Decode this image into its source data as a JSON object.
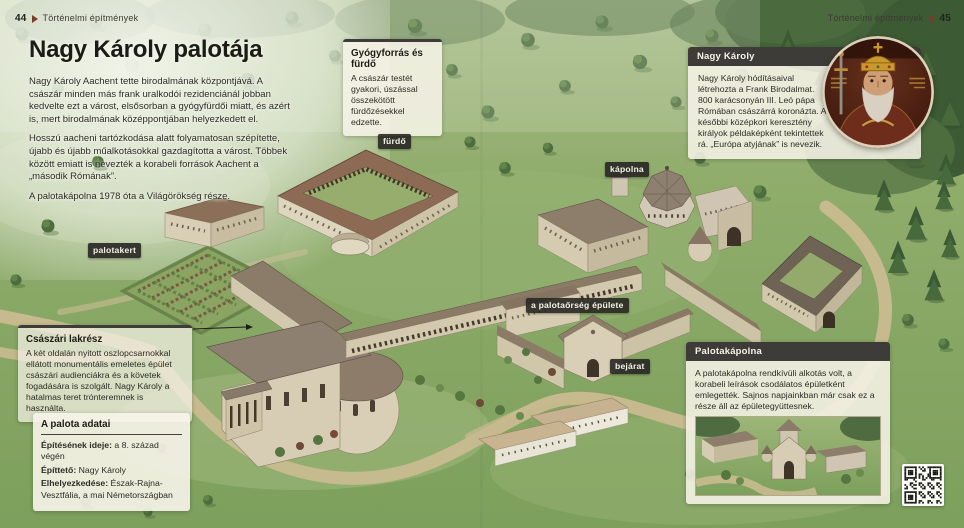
{
  "header": {
    "left": {
      "page_number": "44",
      "section": "Történelmi építmények"
    },
    "right": {
      "page_number": "45",
      "section": "Történelmi építmények"
    }
  },
  "article": {
    "title": "Nagy Károly palotája",
    "paragraphs": [
      "Nagy Károly Aachent tette birodalmának központjává. A császár minden más frank uralkodói rezidenciánál jobban kedvelte ezt a várost, elsősorban a gyógyfürdői miatt, és azért is, mert birodalmának középpontjában helyezkedett el.",
      "Hosszú aacheni tartózkodása alatt folyamatosan szépítette, újabb és újabb műalkotásokkal gazdagította a várost. Többek között emiatt is nevezték a korabeli források Aachent a „második Rómának”.",
      "A palotakápolna 1978 óta a Világörökség része."
    ]
  },
  "callouts": {
    "bath": {
      "title": "Gyógyforrás és fürdő",
      "body": "A császár testét gyakori, úszással összekötött fürdőzésekkel edzette."
    },
    "charlemagne": {
      "title": "Nagy Károly",
      "body": "Nagy Károly hódításaival létrehozta a Frank Birodalmat. 800 karácsonyán III. Leó pápa Rómában császárrá koronázta. A későbbi középkori keresztény királyok példaképként tekintettek rá. „Európa atyjának” is nevezik."
    },
    "imperial": {
      "title": "Császári lakrész",
      "body": "A két oldalán nyitott oszlopcsarnokkal ellátott monumentális emeletes épület császári audienciákra és a követek fogadására is szolgált. Nagy Károly a hatalmas teret trónteremnek is használta."
    },
    "data": {
      "title": "A palota adatai",
      "rows": [
        {
          "label": "Építésének ideje:",
          "value": " a 8. század végén"
        },
        {
          "label": "Építtető:",
          "value": " Nagy Károly"
        },
        {
          "label": "Elhelyezkedése:",
          "value": " Észak-Rajna-Vesztfália, a mai Németországban"
        }
      ]
    },
    "chapel": {
      "title": "Palotakápolna",
      "body": "A palotakápolna rendkívüli alkotás volt, a korabeli leírások csodálatos épületként emlegették. Sajnos napjainkban már csak ez a része áll az épületegyüttesnek."
    }
  },
  "map_labels": {
    "bath": "fürdő",
    "chapel": "kápolna",
    "garden": "palotakert",
    "guard": "a palotaőrség épülete",
    "entrance": "bejárat"
  },
  "icons": {
    "header_left_marker": "arrow-right-icon",
    "header_right_marker": "arrow-left-icon",
    "qr": "qr-code"
  },
  "colors": {
    "dark_bar": "#3d3c38",
    "cream_box": "#f6f3e7",
    "marker_maroon": "#7d3a26",
    "grass": "#8fac6b",
    "path": "#c9bb90"
  }
}
